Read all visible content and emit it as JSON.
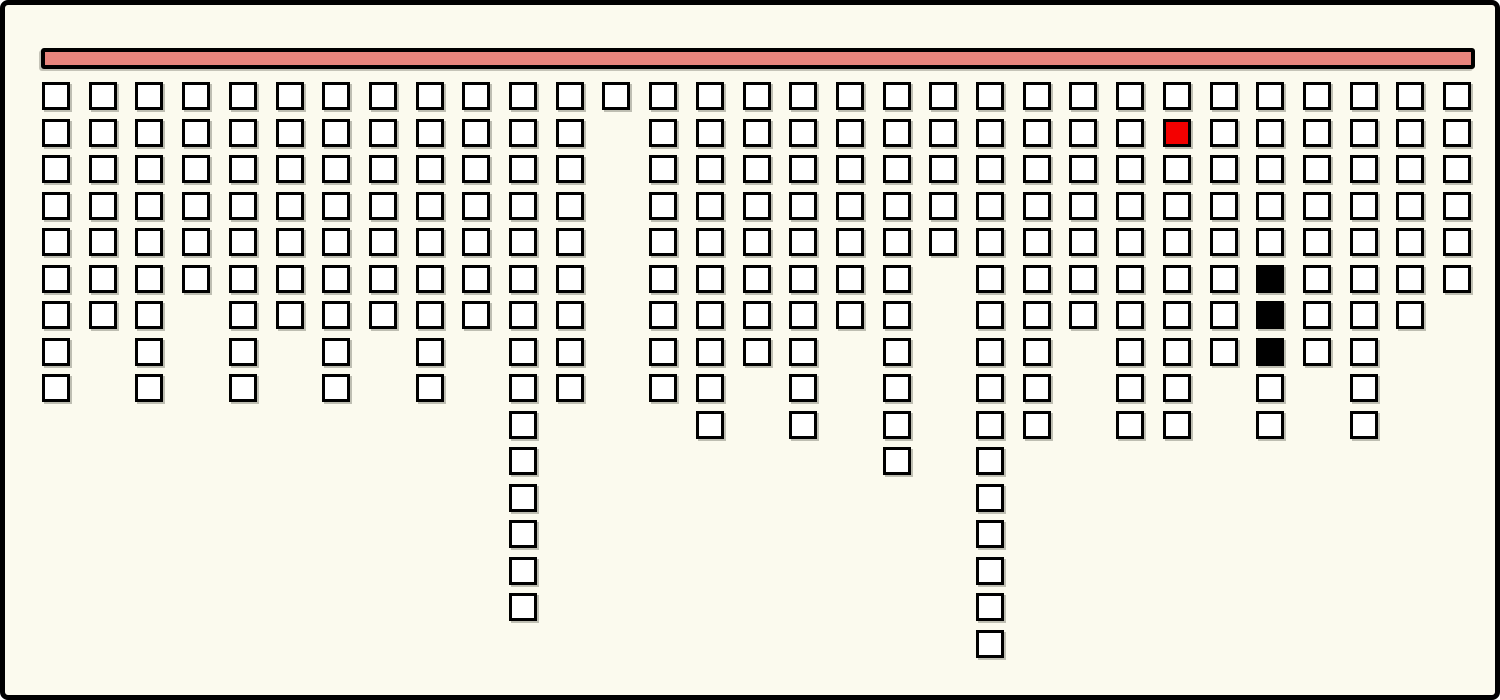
{
  "window": {
    "background_color": "#FBFAEE",
    "border_color": "#000000"
  },
  "bar": {
    "fill_color": "#E8857D",
    "border_color": "#000000"
  },
  "blocks": {
    "default_fill": "#FFFFFF",
    "border_color": "#000000",
    "red_fill": "#F40000",
    "black_fill": "#000000",
    "grid_rows_max": 16,
    "grid_columns": 31,
    "column_heights": [
      9,
      7,
      9,
      6,
      9,
      7,
      9,
      7,
      9,
      7,
      15,
      9,
      1,
      9,
      10,
      8,
      10,
      7,
      11,
      5,
      16,
      10,
      7,
      10,
      10,
      8,
      10,
      8,
      10,
      7,
      6
    ],
    "special_blocks": [
      {
        "column": 25,
        "row": 2,
        "type": "red"
      },
      {
        "column": 27,
        "row": 6,
        "type": "black"
      },
      {
        "column": 27,
        "row": 7,
        "type": "black"
      },
      {
        "column": 27,
        "row": 8,
        "type": "black"
      }
    ],
    "total_blocks": 266
  }
}
